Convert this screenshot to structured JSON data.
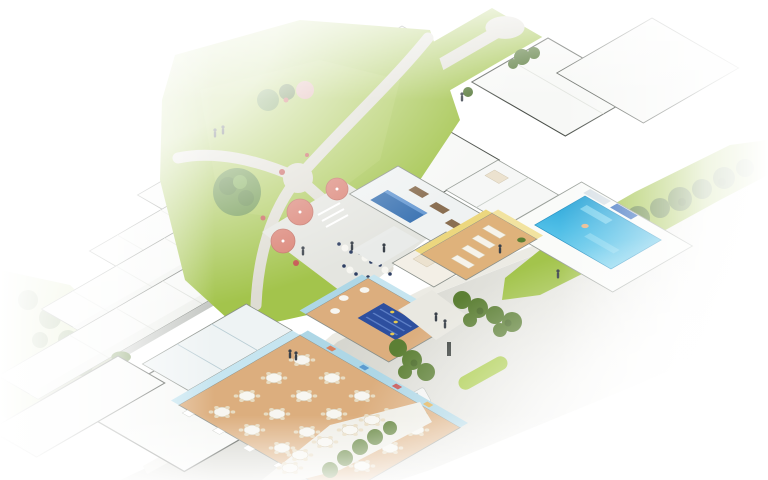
{
  "scene": {
    "type": "isometric-architectural-cutaway-rendering",
    "subject": "residential care campus with courtyard garden, dining hall, spa and pool",
    "background": "#ffffff"
  },
  "palette": {
    "roofWhite": "#f7f8f6",
    "roofShade": "#edefeb",
    "roofEdge": "#575c56",
    "wallDark": "#3f443f",
    "facade": "#e5e8e4",
    "lawn": "#a3c44c",
    "lawnLight": "#c3d789",
    "hedge": "#5c7f34",
    "hedgeDark": "#49682a",
    "path": "#dedcd3",
    "road": "#d4d4cd",
    "sidewalk": "#ecebe4",
    "median": "#a5c93e",
    "floorTan": "#dcae7e",
    "wallBlue": "#aed7e6",
    "wallBlueLight": "#c6e5f0",
    "accentBlue": "#3f76b4",
    "matsBlue": "#2d4f9f",
    "poolBlue": "#2aa3d6",
    "poolLight": "#79d2ef",
    "spaYellow": "#ecd77e",
    "spaFloor": "#dfb27b",
    "cream": "#f3efe6",
    "bedCream": "#ece2cf",
    "umbrella": "#d97e70",
    "umbrellaPink": "#dba8a4",
    "tableWhite": "#f7f6f1",
    "chairBeige": "#e8dcc2",
    "figure": "#3a414a",
    "van": "#f3f4f3",
    "treeGreen": "#628f3f",
    "treeDark": "#4f7330",
    "flowerRed": "#c4524d",
    "deskWood": "#8a6f52"
  },
  "elements": {
    "dining_hall": {
      "round_tables": 19,
      "people": 2
    },
    "outdoor_terrace": {
      "tables": 5
    },
    "cafe_terrace": {
      "umbrellas": 3
    },
    "garden": {
      "large_trees": 1,
      "small_trees": 5,
      "flower_beds": 5,
      "pink_umbrellas": 1
    },
    "pool_room": {
      "pools": 1,
      "loungers": 2,
      "swimmers": 1
    },
    "spa_room": {
      "loungers": 4
    },
    "lounge": {
      "mat_rows": 1,
      "cafe_tables": 3
    },
    "office": {
      "desks": 3,
      "accent_walls": 1
    },
    "townhouse_rows": 5,
    "roof_blocks": 6,
    "road": {
      "median_strips": 1,
      "vehicles": 1
    },
    "people_total": 12
  }
}
